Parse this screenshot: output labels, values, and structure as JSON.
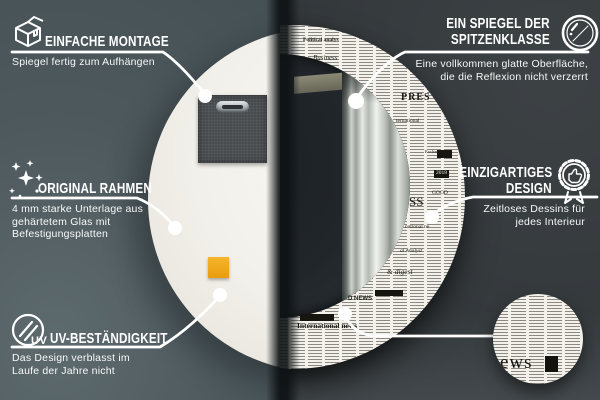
{
  "callouts": {
    "montage": {
      "title": "EINFACHE MONTAGE",
      "desc": "Spiegel fertig zum Aufhängen"
    },
    "rahmen": {
      "title": "ORIGINAL RAHMEN",
      "desc": "4 mm starke Unterlage aus gehärtetem Glas mit Befestigungsplatten"
    },
    "uv": {
      "title": "UV-BESTÄNDIGKEIT",
      "desc": "Das Design verblasst im Laufe der Jahre nicht",
      "icon_label": "UV"
    },
    "spiegel": {
      "title_line1": "EIN SPIEGEL DER",
      "title_line2": "SPITZENKLASSE",
      "desc": "Eine vollkommen glatte Oberfläche, die die Reflexion nicht verzerrt"
    },
    "design": {
      "title_line1": "EINZIGARTIGES",
      "title_line2": "DESIGN",
      "desc": "Zeitloses Dessins für jedes Interieur"
    }
  },
  "mirror_design": {
    "words": [
      "Political analys",
      "Business",
      "ternational",
      "PRES",
      "Exchange rates",
      "2018",
      "GOOD",
      "SS",
      "national ne",
      "al Analyst",
      "& digest",
      "D NEWS",
      "International news"
    ],
    "detail_word": "ews"
  },
  "colors": {
    "background_left": "#4e595d",
    "background_right": "#33383b",
    "accent": "#ffffff",
    "adhesive_pad": "#eda51c",
    "newsprint": "#f3f1ea",
    "glass": "#22272a"
  }
}
